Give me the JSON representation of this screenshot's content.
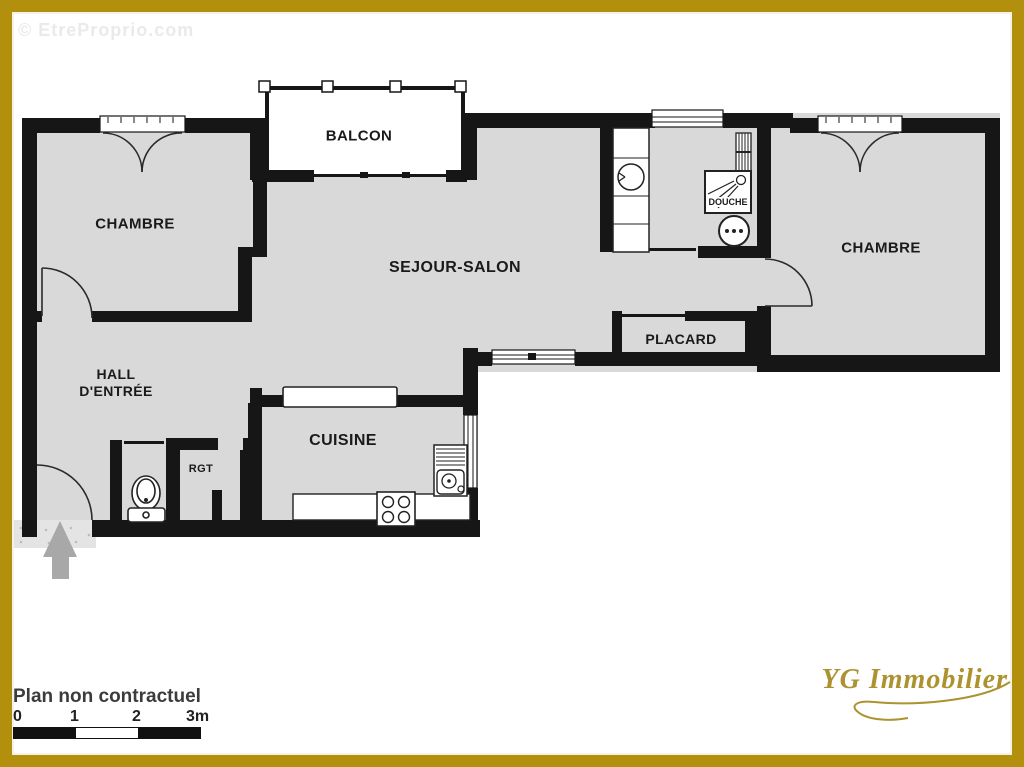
{
  "watermark": "© EtreProprio.com",
  "rooms": {
    "balcony": "BALCON",
    "bedroom_left": "CHAMBRE",
    "living_room": "SEJOUR-SALON",
    "bedroom_right": "CHAMBRE",
    "shower": "DOUCHE",
    "closet": "PLACARD",
    "hall_line1": "HALL",
    "hall_line2": "D'ENTRÉE",
    "storage": "RGT",
    "kitchen": "CUISINE"
  },
  "footer": {
    "disclaimer": "Plan non contractuel",
    "scale_ticks": [
      "0",
      "1",
      "2",
      "3m"
    ],
    "logo": "YG Immobilier"
  },
  "icons": {
    "entrance_arrow": "up-arrow",
    "toilet": "toilet-wc",
    "washbasin": "round-basin",
    "washing_machine": "washing-machine-drum",
    "shower_head": "shower-spray",
    "stove": "four-burner-hob",
    "kitchen_sink": "sink-with-drainer",
    "radiator": "radiator-hatched"
  },
  "colors": {
    "frame_gold": "#b2900e",
    "logo_gold": "#ac9330",
    "wall_black": "#161616",
    "room_fill": "#d9d9d9",
    "watermark_gray": "#eaeaea",
    "arrow_gray": "#a8a8a8"
  }
}
